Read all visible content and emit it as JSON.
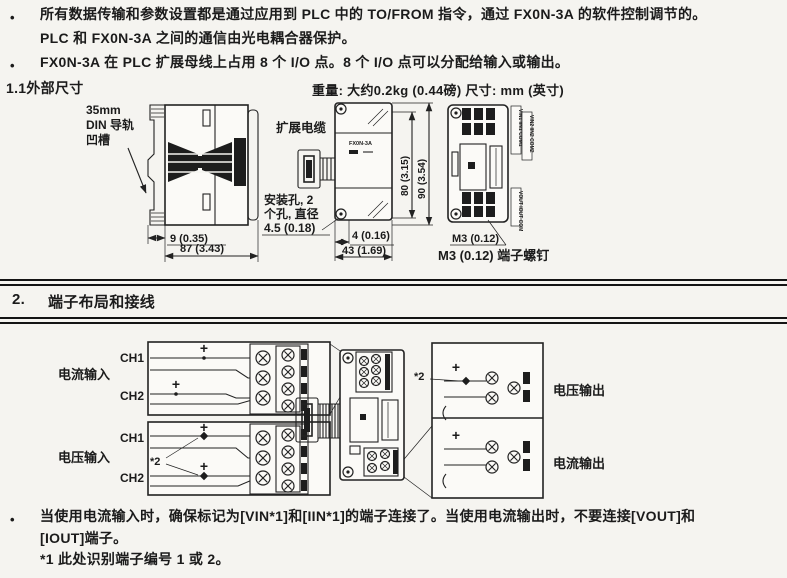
{
  "page": {
    "bg": "#f5f4f0",
    "ink": "#1b1b1b"
  },
  "intro": {
    "bullet": "•",
    "b1l1": "所有数据传输和参数设置都是通过应用到 PLC 中的 TO/FROM 指令，通过 FX0N-3A 的软件控制调节的。",
    "b1l2": "PLC 和 FX0N-3A 之间的通信由光电耦合器保护。",
    "b2": "FX0N-3A 在 PLC 扩展母线上占用 8 个 I/O 点。8 个 I/O 点可以分配给输入或输出。"
  },
  "dims": {
    "heading": "1.1外部尺寸",
    "weight_note": "重量: 大约0.2kg (0.44磅) 尺寸: mm (英寸)",
    "din1": "35mm",
    "din2": "DIN 导轨",
    "din3": "凹槽",
    "ext_cable": "扩展电缆",
    "hole1": "安装孔, 2",
    "hole2": "个孔, 直径",
    "hole3": "4.5 (0.18)",
    "d9": "9 (0.35)",
    "d87": "87 (3.43)",
    "d80": "80 (3.15)",
    "d90": "90 (3.54)",
    "d4": "4 (0.16)",
    "d43": "43 (1.69)",
    "m3": "M3 (0.12)",
    "m3_screw": "M3 (0.12) 端子螺钉",
    "module_name": "FX0N-3A",
    "t_in1": "VIN1 IIN1 COM1",
    "t_in2": "VIN2 IIN2 COM2",
    "t_out": "VOUT IOUT COM"
  },
  "section2": {
    "number": "2.",
    "heading": "端子布局和接线",
    "current_input": "电流输入",
    "voltage_input": "电压输入",
    "voltage_output": "电压输出",
    "current_output": "电流输出",
    "ch1": "CH1",
    "ch2": "CH2",
    "plus": "+",
    "star2": "*2"
  },
  "notes": {
    "bullet": "•",
    "l1": "当使用电流输入时，确保标记为[VIN*1]和[IIN*1]的端子连接了。当使用电流输出时，不要连接[VOUT]和",
    "l2": "[IOUT]端子。",
    "footnote": "*1 此处识别端子编号 1 或 2。"
  }
}
